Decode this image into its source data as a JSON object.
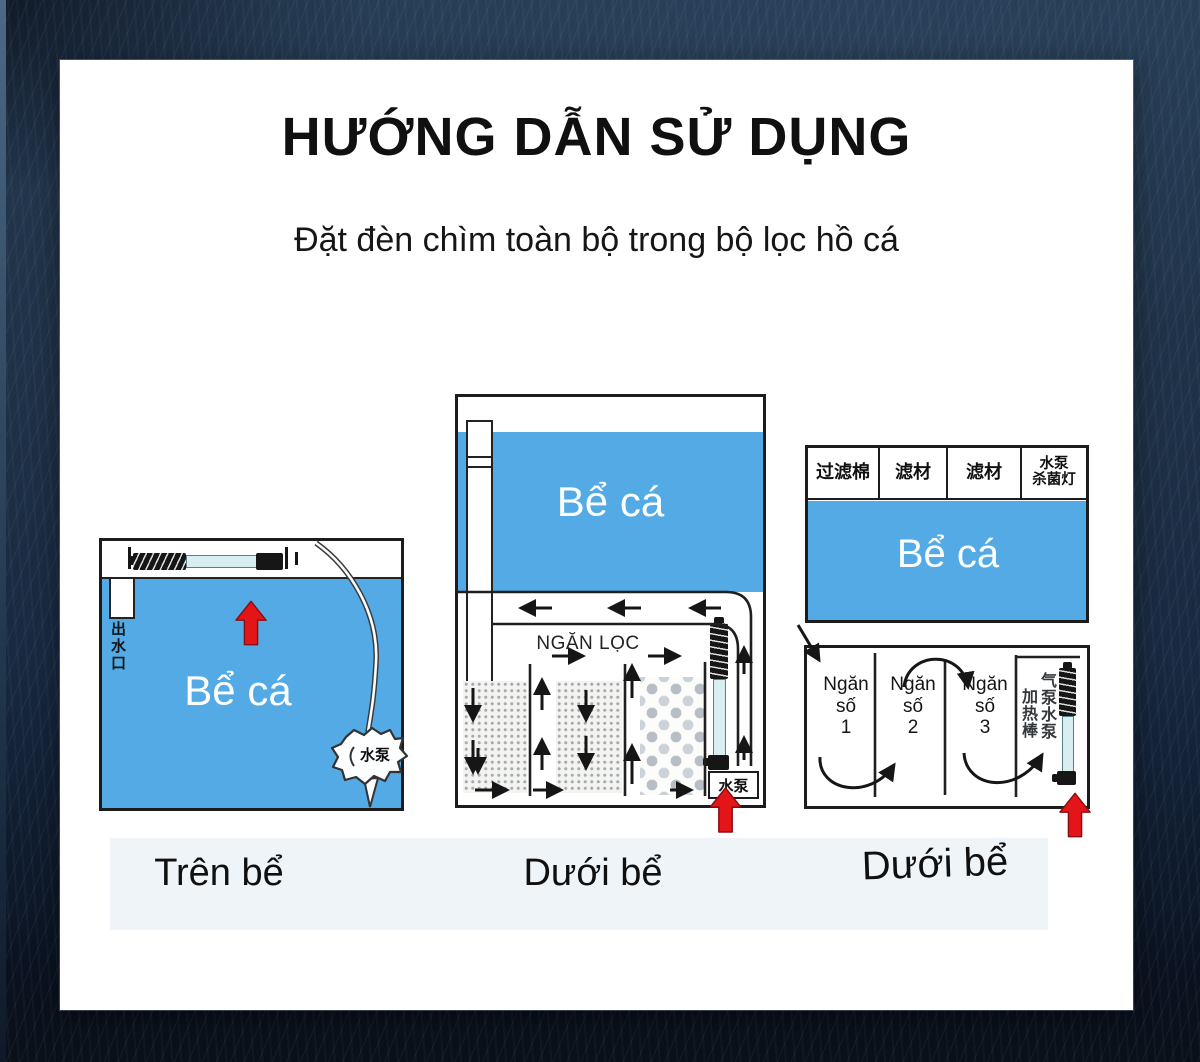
{
  "page": {
    "title": "HƯỚNG DẪN SỬ DỤNG",
    "subtitle": "Đặt đèn chìm toàn bộ trong bộ lọc hồ cá"
  },
  "colors": {
    "background_navy": "#1f3148",
    "card_white": "#ffffff",
    "water_blue": "#53aae4",
    "arrow_red": "#e41519",
    "line_black": "#1c1c1c",
    "caption_band": "#eef4f8"
  },
  "diagram_on_tank": {
    "caption": "Trên bể",
    "tank_label": "Bể cá",
    "outlet_label": "出水口",
    "pump_label": "水泵"
  },
  "diagram_sump_flow": {
    "caption": "Dưới bể",
    "tank_label": "Bể cá",
    "filter_label": "NGĂN LỌC",
    "pump_label": "水泵"
  },
  "diagram_sump_compartments": {
    "caption": "Dưới bể",
    "tank_label": "Bể cá",
    "header_cells": [
      {
        "lines": [
          "过滤棉"
        ]
      },
      {
        "lines": [
          "滤材"
        ]
      },
      {
        "lines": [
          "滤材"
        ]
      },
      {
        "lines": [
          "水泵",
          "杀菌灯"
        ]
      }
    ],
    "compartments": [
      {
        "lines": [
          "Ngăn",
          "số",
          "1"
        ]
      },
      {
        "lines": [
          "Ngăn",
          "số",
          "2"
        ]
      },
      {
        "lines": [
          "Ngăn",
          "số",
          "3"
        ]
      }
    ],
    "heater_label": "加热棒",
    "pump_label": "气泵水泵"
  }
}
